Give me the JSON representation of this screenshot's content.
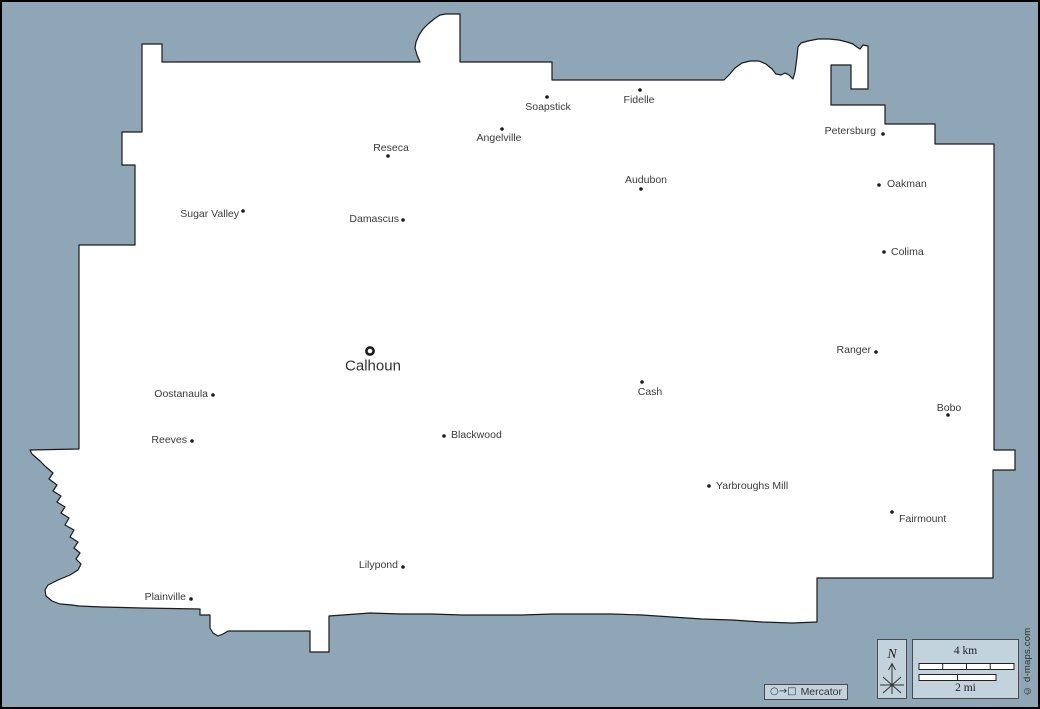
{
  "map": {
    "width": 1040,
    "height": 709,
    "background_color": "#8EA6B5",
    "county_fill": "#FFFFFF",
    "county_stroke": "#1A1A1A",
    "dot_color": "#1A1A1A",
    "dot_radius": 1.8,
    "outline": [
      [
        140,
        42
      ],
      [
        160,
        42
      ],
      [
        160,
        60
      ],
      [
        418,
        60
      ],
      [
        415,
        53
      ],
      [
        413,
        46
      ],
      [
        414,
        40
      ],
      [
        417,
        33
      ],
      [
        421,
        27
      ],
      [
        426,
        22
      ],
      [
        432,
        17
      ],
      [
        438,
        13
      ],
      [
        444,
        12
      ],
      [
        458,
        12
      ],
      [
        458,
        60
      ],
      [
        550,
        60
      ],
      [
        550,
        78
      ],
      [
        722,
        78
      ],
      [
        727,
        73
      ],
      [
        733,
        66
      ],
      [
        740,
        61
      ],
      [
        748,
        59
      ],
      [
        757,
        59
      ],
      [
        764,
        62
      ],
      [
        770,
        67
      ],
      [
        774,
        72
      ],
      [
        779,
        73
      ],
      [
        783,
        71
      ],
      [
        787,
        73
      ],
      [
        791,
        77
      ],
      [
        793,
        70
      ],
      [
        795,
        55
      ],
      [
        796,
        45
      ],
      [
        799,
        41
      ],
      [
        806,
        39
      ],
      [
        816,
        37
      ],
      [
        827,
        37
      ],
      [
        837,
        38
      ],
      [
        845,
        40
      ],
      [
        851,
        42
      ],
      [
        855,
        45
      ],
      [
        858,
        47
      ],
      [
        861,
        43
      ],
      [
        866,
        44
      ],
      [
        866,
        87
      ],
      [
        849,
        87
      ],
      [
        849,
        63
      ],
      [
        829,
        63
      ],
      [
        829,
        103
      ],
      [
        883,
        103
      ],
      [
        883,
        122
      ],
      [
        933,
        122
      ],
      [
        933,
        142
      ],
      [
        992,
        142
      ],
      [
        992,
        448
      ],
      [
        1013,
        448
      ],
      [
        1013,
        468
      ],
      [
        991,
        468
      ],
      [
        991,
        576
      ],
      [
        815,
        576
      ],
      [
        815,
        620
      ],
      [
        790,
        621
      ],
      [
        760,
        620
      ],
      [
        730,
        618
      ],
      [
        700,
        617
      ],
      [
        670,
        615
      ],
      [
        640,
        613
      ],
      [
        610,
        612
      ],
      [
        580,
        612
      ],
      [
        550,
        612
      ],
      [
        520,
        613
      ],
      [
        490,
        613
      ],
      [
        460,
        613
      ],
      [
        430,
        612
      ],
      [
        400,
        612
      ],
      [
        368,
        611
      ],
      [
        327,
        614
      ],
      [
        327,
        650
      ],
      [
        308,
        650
      ],
      [
        308,
        629
      ],
      [
        226,
        629
      ],
      [
        221,
        632
      ],
      [
        216,
        634
      ],
      [
        211,
        631
      ],
      [
        208,
        626
      ],
      [
        208,
        613
      ],
      [
        198,
        613
      ],
      [
        198,
        607
      ],
      [
        140,
        606
      ],
      [
        100,
        605
      ],
      [
        77,
        604
      ],
      [
        70,
        603
      ],
      [
        58,
        602
      ],
      [
        50,
        599
      ],
      [
        44,
        594
      ],
      [
        43,
        588
      ],
      [
        46,
        583
      ],
      [
        56,
        578
      ],
      [
        68,
        573
      ],
      [
        76,
        568
      ],
      [
        79,
        562
      ],
      [
        74,
        557
      ],
      [
        78,
        551
      ],
      [
        72,
        546
      ],
      [
        76,
        540
      ],
      [
        68,
        535
      ],
      [
        72,
        528
      ],
      [
        63,
        523
      ],
      [
        67,
        516
      ],
      [
        59,
        511
      ],
      [
        63,
        505
      ],
      [
        55,
        500
      ],
      [
        59,
        494
      ],
      [
        51,
        489
      ],
      [
        55,
        483
      ],
      [
        47,
        477
      ],
      [
        51,
        471
      ],
      [
        44,
        465
      ],
      [
        38,
        459
      ],
      [
        30,
        452
      ],
      [
        28,
        448
      ],
      [
        77,
        447
      ],
      [
        77,
        243
      ],
      [
        133,
        243
      ],
      [
        133,
        163
      ],
      [
        120,
        163
      ],
      [
        120,
        130
      ],
      [
        140,
        130
      ]
    ],
    "county_seat": {
      "name": "Calhoun",
      "ring": [
        368,
        349
      ],
      "label": [
        371,
        364
      ]
    },
    "towns": [
      {
        "name": "Soapstick",
        "dot": [
          545,
          95
        ],
        "label": [
          546,
          105
        ],
        "anchor": "middle"
      },
      {
        "name": "Fidelle",
        "dot": [
          638,
          88
        ],
        "label": [
          637,
          98
        ],
        "anchor": "middle"
      },
      {
        "name": "Angelville",
        "dot": [
          500,
          127
        ],
        "label": [
          497,
          136
        ],
        "anchor": "middle"
      },
      {
        "name": "Petersburg",
        "dot": [
          881,
          132
        ],
        "label": [
          874,
          129
        ],
        "anchor": "end"
      },
      {
        "name": "Reseca",
        "dot": [
          386,
          154
        ],
        "label": [
          389,
          146
        ],
        "anchor": "middle"
      },
      {
        "name": "Audubon",
        "dot": [
          639,
          187
        ],
        "label": [
          644,
          178
        ],
        "anchor": "middle"
      },
      {
        "name": "Oakman",
        "dot": [
          877,
          183
        ],
        "label": [
          885,
          182
        ],
        "anchor": "start"
      },
      {
        "name": "Sugar Valley",
        "dot": [
          241,
          209
        ],
        "label": [
          237,
          212
        ],
        "anchor": "end"
      },
      {
        "name": "Damascus",
        "dot": [
          401,
          218
        ],
        "label": [
          397,
          217
        ],
        "anchor": "end"
      },
      {
        "name": "Colima",
        "dot": [
          882,
          250
        ],
        "label": [
          889,
          250
        ],
        "anchor": "start"
      },
      {
        "name": "Ranger",
        "dot": [
          874,
          350
        ],
        "label": [
          869,
          348
        ],
        "anchor": "end"
      },
      {
        "name": "Cash",
        "dot": [
          640,
          380
        ],
        "label": [
          648,
          390
        ],
        "anchor": "middle"
      },
      {
        "name": "Oostanaula",
        "dot": [
          211,
          393
        ],
        "label": [
          206,
          392
        ],
        "anchor": "end"
      },
      {
        "name": "Bobo",
        "dot": [
          946,
          413
        ],
        "label": [
          947,
          406
        ],
        "anchor": "middle"
      },
      {
        "name": "Blackwood",
        "dot": [
          442,
          434
        ],
        "label": [
          449,
          433
        ],
        "anchor": "start"
      },
      {
        "name": "Reeves",
        "dot": [
          190,
          439
        ],
        "label": [
          185,
          438
        ],
        "anchor": "end"
      },
      {
        "name": "Yarbroughs Mill",
        "dot": [
          707,
          484
        ],
        "label": [
          714,
          484
        ],
        "anchor": "start"
      },
      {
        "name": "Fairmount",
        "dot": [
          890,
          510
        ],
        "label": [
          897,
          517
        ],
        "anchor": "start"
      },
      {
        "name": "Lilypond",
        "dot": [
          401,
          565
        ],
        "label": [
          396,
          563
        ],
        "anchor": "end"
      },
      {
        "name": "Plainville",
        "dot": [
          189,
          597
        ],
        "label": [
          184,
          595
        ],
        "anchor": "end"
      }
    ]
  },
  "legend": {
    "box_fill": "#C3D3DD",
    "north_label": "N",
    "scale_km_label": "4 km",
    "scale_mi_label": "2 mi",
    "projection_symbol": "○→□",
    "projection_label": "Mercator",
    "copyright": "© d-maps.com"
  }
}
